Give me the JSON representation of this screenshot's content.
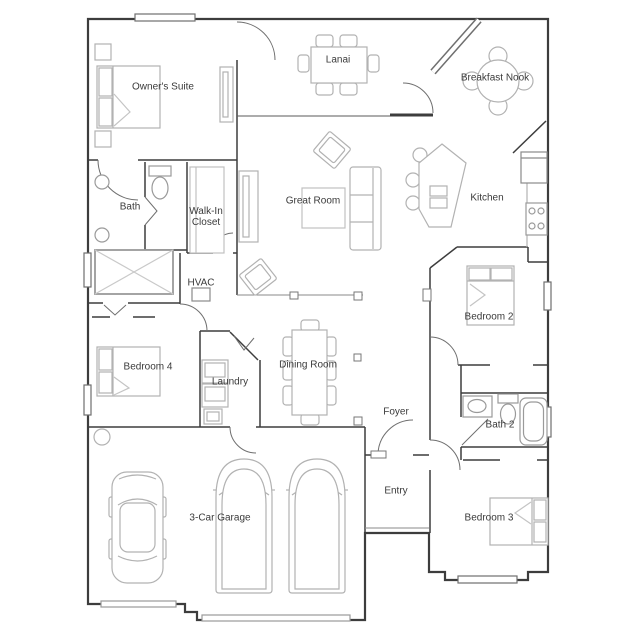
{
  "meta": {
    "type": "residential floor plan",
    "storeys": "single level"
  },
  "palette": {
    "bg": "#ffffff",
    "wall": "#3d3d3d",
    "door": "#6f6f6f",
    "window": "#7a7a7a",
    "furniture": "#b2b2b2",
    "fixture": "#9a9a9a",
    "label": "#3a3a3a"
  },
  "rooms": [
    {
      "id": "owners-suite",
      "label": "Owner's Suite"
    },
    {
      "id": "lanai",
      "label": "Lanai"
    },
    {
      "id": "breakfast-nook",
      "label": "Breakfast Nook"
    },
    {
      "id": "bath",
      "label": "Bath"
    },
    {
      "id": "walk-in-closet",
      "label": "Walk-In Closet"
    },
    {
      "id": "great-room",
      "label": "Great Room"
    },
    {
      "id": "kitchen",
      "label": "Kitchen"
    },
    {
      "id": "hvac",
      "label": "HVAC"
    },
    {
      "id": "bedroom-2",
      "label": "Bedroom 2"
    },
    {
      "id": "bedroom-4",
      "label": "Bedroom 4"
    },
    {
      "id": "laundry",
      "label": "Laundry"
    },
    {
      "id": "dining-room",
      "label": "Dining Room"
    },
    {
      "id": "foyer",
      "label": "Foyer"
    },
    {
      "id": "bath-2",
      "label": "Bath 2"
    },
    {
      "id": "entry",
      "label": "Entry"
    },
    {
      "id": "garage",
      "label": "3-Car Garage"
    },
    {
      "id": "bedroom-3",
      "label": "Bedroom 3"
    }
  ]
}
